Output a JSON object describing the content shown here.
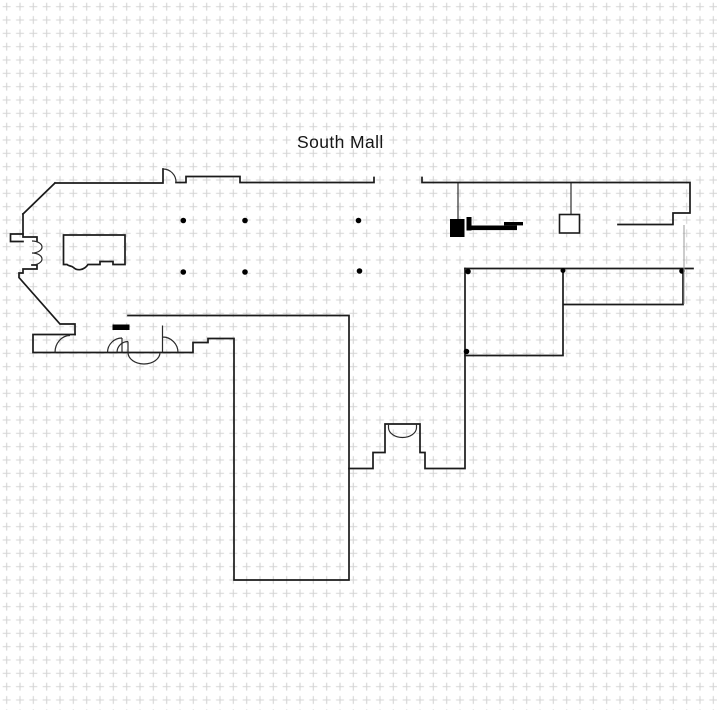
{
  "title": {
    "text": "South Mall"
  },
  "drawing": {
    "description": "architectural floor plan on dashed grid",
    "line_color": "#1b1b1b",
    "door_color": "#2a2a2a",
    "grid_color": "#d5d5d5",
    "column_fill": "#000000",
    "column_count": 10
  }
}
